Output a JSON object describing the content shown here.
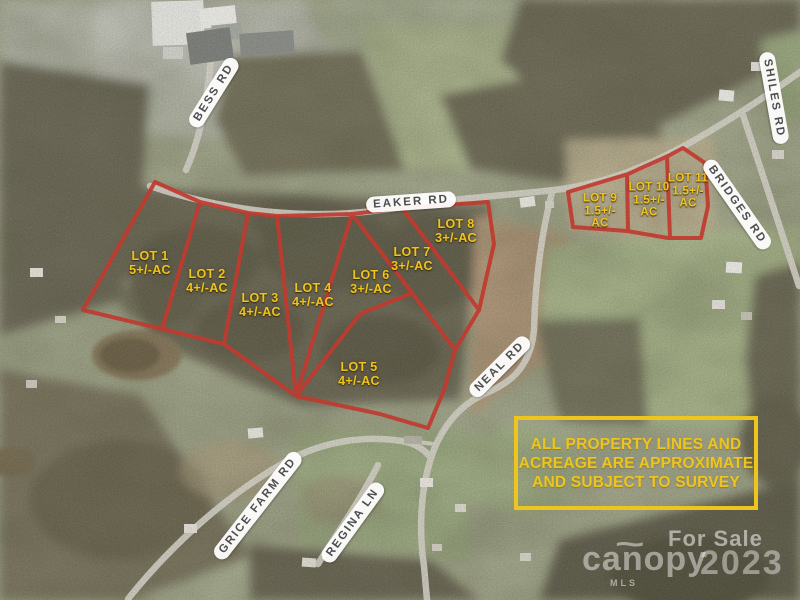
{
  "colors": {
    "boundary_red": "#c13a2f",
    "lot_label_yellow": "#efc51d",
    "disclaimer_yellow": "#eec41e",
    "road_label_text": "#4e4e4e",
    "road_label_bg": "#ffffff",
    "watermark_white": "#ffffff"
  },
  "roads": [
    {
      "name": "BESS RD"
    },
    {
      "name": "EAKER RD"
    },
    {
      "name": "SHILES RD"
    },
    {
      "name": "BRIDGES RD"
    },
    {
      "name": "NEAL RD"
    },
    {
      "name": "GRICE FARM RD"
    },
    {
      "name": "REGINA LN"
    }
  ],
  "lots": [
    {
      "label": "LOT 1",
      "acre": "5+/-AC"
    },
    {
      "label": "LOT 2",
      "acre": "4+/-AC"
    },
    {
      "label": "LOT 3",
      "acre": "4+/-AC"
    },
    {
      "label": "LOT 4",
      "acre": "4+/-AC"
    },
    {
      "label": "LOT 5",
      "acre": "4+/-AC"
    },
    {
      "label": "LOT 6",
      "acre": "3+/-AC"
    },
    {
      "label": "LOT 7",
      "acre": "3+/-AC"
    },
    {
      "label": "LOT 8",
      "acre": "3+/-AC"
    },
    {
      "label": "LOT 9",
      "acre": "1.5+/-",
      "acre2": "AC"
    },
    {
      "label": "LOT 10",
      "acre": "1.5+/-",
      "acre2": "AC"
    },
    {
      "label": "LOT 11",
      "acre": "1.5+/-",
      "acre2": "AC"
    }
  ],
  "disclaimer": {
    "lines": [
      "ALL PROPERTY LINES AND",
      "ACREAGE ARE APPROXIMATE",
      "AND SUBJECT TO SURVEY"
    ]
  },
  "watermark": {
    "for_sale": "For Sale",
    "brand": "canopy",
    "brand_accent": "~",
    "brand_sub": "MLS",
    "year": "2023"
  }
}
